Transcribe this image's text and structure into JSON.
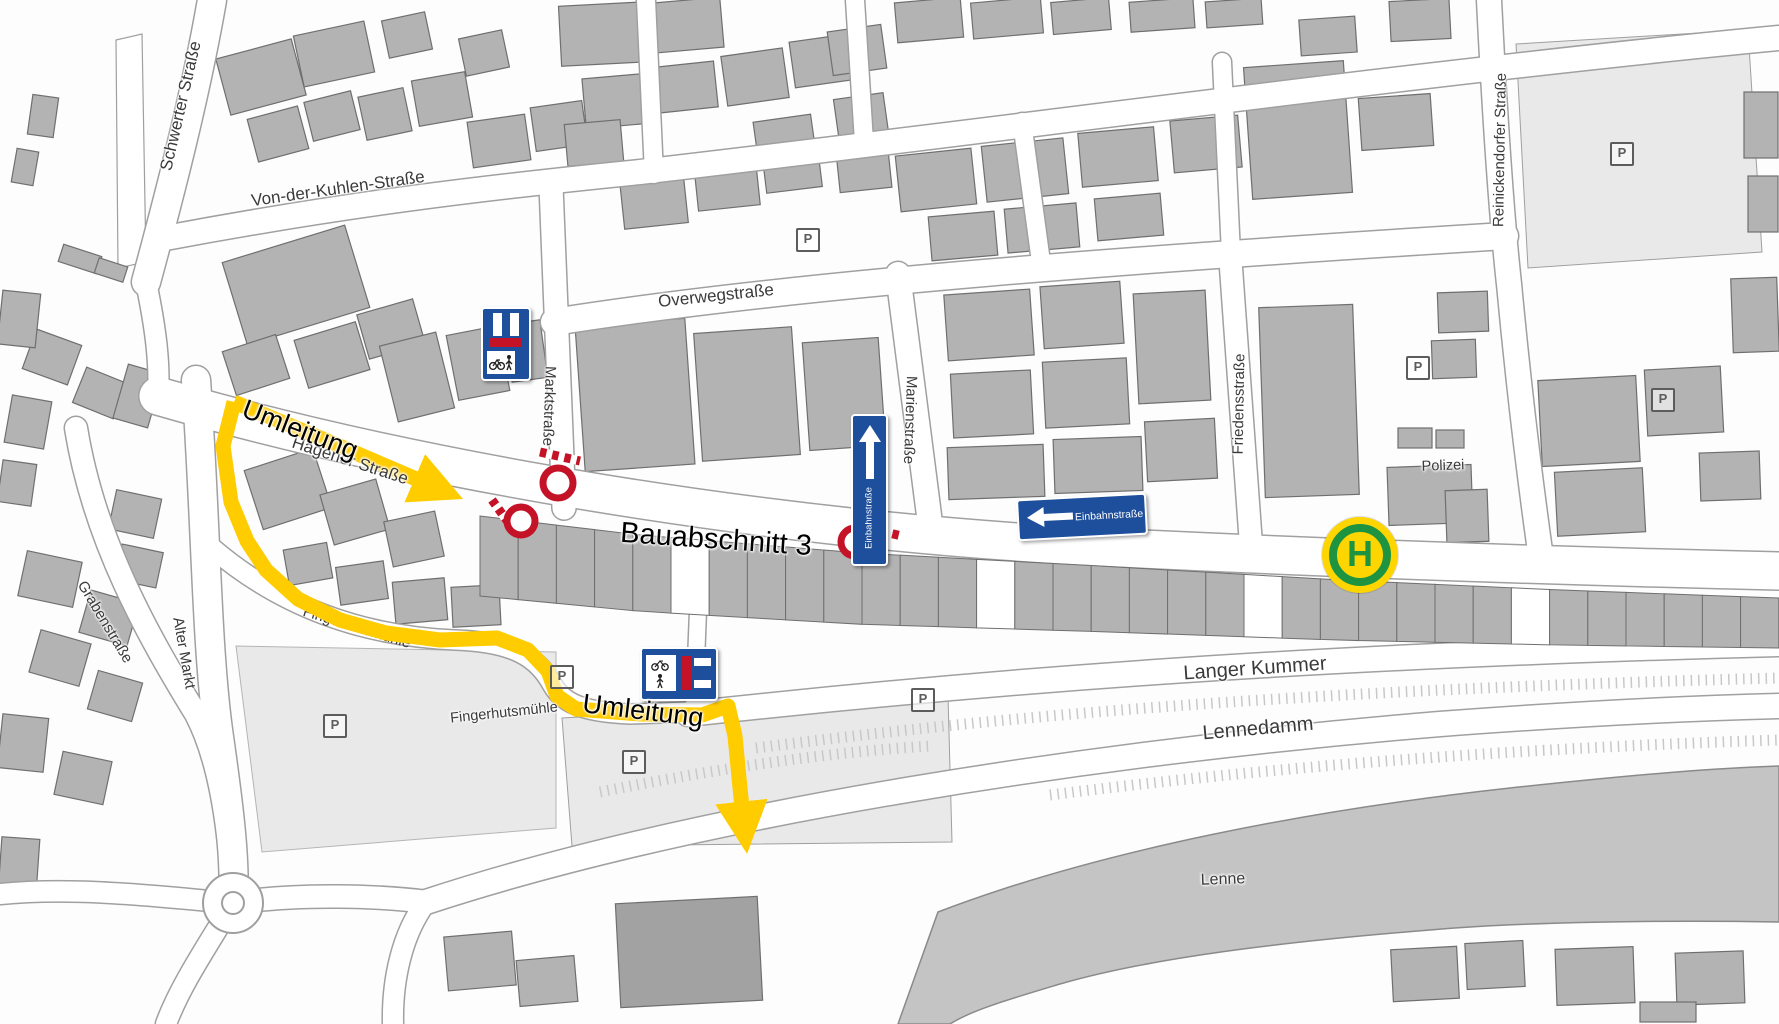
{
  "colors": {
    "yellow": "#FFCC00",
    "red": "#C41227",
    "blue": "#1E4F9C",
    "green": "#1E9440",
    "bus_yellow": "#FFD500",
    "building": "#B3B3B3",
    "building_dark": "#A2A2A2",
    "river": "#C4C4C4",
    "patch": "#E9E9E9",
    "casing": "#A0A0A0",
    "label": "#3A3A3A"
  },
  "labels": {
    "schwerter": "Schwerter Straße",
    "vdk": "Von-der-Kuhlen-Straße",
    "overweg": "Overwegstraße",
    "markt": "Marktstraße",
    "hagener": "Hagener Straße",
    "marien": "Marienstraße",
    "friedens": "Friedensstraße",
    "reinickendorfer": "Reinickendorfer Straße",
    "polizei": "Polizei",
    "graben": "Grabenstraße",
    "altermarkt": "Alter Markt",
    "fingerhut": "Fingerhutsmühle",
    "fingerhut2": "Fingerhutsmühle",
    "langerkummer": "Langer Kummer",
    "lennedamm": "Lennedamm",
    "lenne": "Lenne",
    "umleitung1": "Umleitung",
    "umleitung2": "Umleitung",
    "bauabschnitt": "Bauabschnitt 3",
    "parking": "P",
    "busstop": "H",
    "einbahn": "Einbahnstraße"
  },
  "route": {
    "width": 15,
    "paths": {
      "hagener_arrow": "234,402 330,442 428,484",
      "detour_arrow": "234,402 223,446 231,502 247,541 266,570 298,599 340,620 386,633 440,640 497,638 528,650 548,671 557,696 576,709 640,714 702,715 728,706 735,736 740,788 743,816"
    }
  },
  "geometry": {
    "river": "M938,912 C1100,850 1310,810 1510,788 C1650,773 1720,768 1779,766 L1779,922 C1660,920 1520,922 1430,930 C1280,942 1150,958 1060,984 C1010,999 972,1010 950,1024 L898,1024 Z",
    "patches": {
      "lot_ne": "M1516,44 L1748,30 L1762,252 L1528,268 Z",
      "plaza": "M236,646 L556,652 L556,828 L262,852 Z",
      "lot_s": "M562,718 L948,696 L952,842 L572,846 Z",
      "hatch_schwerter": "M118,268 L116,40 L142,34 L146,262 Z"
    },
    "streets": [
      {
        "d": "M158,396 C420,472 760,528 1080,546 C1320,558 1560,566 1779,571",
        "w": 37
      },
      {
        "d": "M551,186 L564,508",
        "w": 23
      },
      {
        "d": "M554,322 C800,283 1150,258 1505,236",
        "w": 26
      },
      {
        "d": "M160,239 C340,205 480,188 640,172 C980,133 1420,72 1779,38",
        "w": 24
      },
      {
        "d": "M146,282 C172,186 196,92 212,0",
        "w": 28
      },
      {
        "d": "M146,282 C156,330 160,364 158,396",
        "w": 20
      },
      {
        "d": "M898,274 L930,523",
        "w": 24
      },
      {
        "d": "M1230,254 L1251,545",
        "w": 22
      },
      {
        "d": "M1489,0 C1495,120 1502,220 1509,284 C1518,380 1530,480 1541,558",
        "w": 24
      },
      {
        "d": "M646,0 L654,174",
        "w": 18
      },
      {
        "d": "M855,0 L864,142",
        "w": 18
      },
      {
        "d": "M1022,122 L1041,262",
        "w": 18
      },
      {
        "d": "M1222,62 L1231,254",
        "w": 18
      },
      {
        "d": "M196,380 C206,520 206,640 218,730 C228,800 236,860 233,903",
        "w": 28
      },
      {
        "d": "M76,428 C94,540 148,636 196,714 C220,760 230,830 233,900",
        "w": 22
      },
      {
        "d": "M212,548 C280,606 360,636 455,640 C515,642 538,658 552,684 C562,702 580,712 630,714 L744,710",
        "w": 19
      },
      {
        "d": "M688,714 C1000,680 1310,656 1779,644",
        "w": 24
      },
      {
        "d": "M426,902 C700,812 1100,752 1440,724 C1600,712 1700,708 1779,706",
        "w": 24
      },
      {
        "d": "M700,560 L694,712",
        "w": 16
      },
      {
        "d": "M233,903 C300,893 380,896 428,902",
        "w": 22
      },
      {
        "d": "M233,903 C206,948 180,986 166,1024",
        "w": 20
      },
      {
        "d": "M233,903 C170,898 80,886 0,894",
        "w": 20
      },
      {
        "d": "M426,902 C402,934 392,980 393,1024",
        "w": 20
      }
    ],
    "terrace": {
      "x0": 480,
      "step": 38.2,
      "n": 34,
      "h0": 80,
      "hslope": -0.0231,
      "white": [
        5,
        13,
        20,
        27
      ],
      "top": [
        [
          480,
          516
        ],
        [
          640,
          535
        ],
        [
          860,
          553
        ],
        [
          1100,
          566
        ],
        [
          1340,
          580
        ],
        [
          1560,
          590
        ],
        [
          1779,
          598
        ]
      ]
    },
    "buildings": [
      [
        222,
        48,
        78,
        58,
        -15
      ],
      [
        298,
        28,
        72,
        52,
        -12
      ],
      [
        385,
        16,
        44,
        38,
        -12
      ],
      [
        252,
        112,
        52,
        44,
        -15
      ],
      [
        308,
        96,
        48,
        40,
        -14
      ],
      [
        362,
        92,
        46,
        44,
        -12
      ],
      [
        415,
        76,
        54,
        46,
        -10
      ],
      [
        462,
        34,
        44,
        38,
        -12
      ],
      [
        470,
        118,
        58,
        46,
        -8
      ],
      [
        533,
        104,
        52,
        44,
        -8
      ],
      [
        30,
        96,
        26,
        40,
        8
      ],
      [
        14,
        150,
        22,
        34,
        10
      ],
      [
        60,
        250,
        40,
        18,
        18
      ],
      [
        96,
        262,
        30,
        16,
        18
      ],
      [
        560,
        4,
        88,
        60,
        -3
      ],
      [
        656,
        0,
        66,
        50,
        -5
      ],
      [
        584,
        76,
        66,
        50,
        -5
      ],
      [
        658,
        64,
        58,
        46,
        -6
      ],
      [
        724,
        52,
        62,
        50,
        -8
      ],
      [
        792,
        38,
        58,
        46,
        -8
      ],
      [
        756,
        118,
        58,
        46,
        -8
      ],
      [
        566,
        122,
        56,
        42,
        -5
      ],
      [
        622,
        178,
        64,
        48,
        -6
      ],
      [
        696,
        162,
        62,
        46,
        -6
      ],
      [
        764,
        148,
        56,
        42,
        -7
      ],
      [
        830,
        28,
        54,
        44,
        -8
      ],
      [
        836,
        96,
        50,
        40,
        -8
      ],
      [
        838,
        150,
        52,
        40,
        -6
      ],
      [
        232,
        242,
        128,
        86,
        -17
      ],
      [
        300,
        330,
        64,
        50,
        -17
      ],
      [
        362,
        306,
        58,
        46,
        -16
      ],
      [
        228,
        342,
        56,
        46,
        -18
      ],
      [
        388,
        338,
        58,
        78,
        -14
      ],
      [
        452,
        330,
        52,
        66,
        -11
      ],
      [
        508,
        322,
        36,
        58,
        -8
      ],
      [
        580,
        322,
        110,
        146,
        -4
      ],
      [
        698,
        330,
        98,
        128,
        -4
      ],
      [
        806,
        340,
        76,
        108,
        -4
      ],
      [
        946,
        292,
        86,
        66,
        -4
      ],
      [
        1042,
        284,
        80,
        62,
        -4
      ],
      [
        952,
        372,
        80,
        64,
        -3
      ],
      [
        1044,
        360,
        84,
        66,
        -3
      ],
      [
        1136,
        292,
        72,
        110,
        -3
      ],
      [
        948,
        446,
        96,
        52,
        -2
      ],
      [
        1054,
        438,
        88,
        54,
        -2
      ],
      [
        1146,
        420,
        70,
        60,
        -3
      ],
      [
        898,
        152,
        76,
        56,
        -6
      ],
      [
        984,
        142,
        82,
        56,
        -6
      ],
      [
        1080,
        130,
        76,
        54,
        -5
      ],
      [
        1172,
        118,
        68,
        52,
        -5
      ],
      [
        1248,
        64,
        100,
        132,
        -4
      ],
      [
        1360,
        96,
        72,
        52,
        -4
      ],
      [
        930,
        214,
        66,
        44,
        -5
      ],
      [
        1006,
        206,
        72,
        44,
        -5
      ],
      [
        1096,
        196,
        66,
        42,
        -5
      ],
      [
        896,
        0,
        66,
        40,
        -5
      ],
      [
        972,
        0,
        70,
        36,
        -5
      ],
      [
        1052,
        0,
        58,
        32,
        -5
      ],
      [
        1130,
        0,
        64,
        30,
        -4
      ],
      [
        1206,
        0,
        56,
        26,
        -4
      ],
      [
        1390,
        0,
        60,
        40,
        -3
      ],
      [
        1300,
        18,
        56,
        36,
        -4
      ],
      [
        1262,
        306,
        94,
        190,
        -2
      ],
      [
        1398,
        428,
        34,
        20,
        0
      ],
      [
        1436,
        430,
        28,
        18,
        0
      ],
      [
        1388,
        466,
        84,
        58,
        -2
      ],
      [
        1438,
        292,
        50,
        40,
        -2
      ],
      [
        1432,
        340,
        44,
        38,
        -2
      ],
      [
        1446,
        490,
        42,
        52,
        -2
      ],
      [
        1540,
        378,
        98,
        86,
        -3
      ],
      [
        1646,
        368,
        76,
        66,
        -3
      ],
      [
        1556,
        470,
        88,
        64,
        -3
      ],
      [
        1744,
        92,
        34,
        66,
        0
      ],
      [
        1748,
        176,
        30,
        56,
        0
      ],
      [
        1732,
        278,
        46,
        74,
        -2
      ],
      [
        1700,
        452,
        60,
        48,
        -2
      ],
      [
        28,
        336,
        48,
        42,
        20
      ],
      [
        78,
        374,
        44,
        38,
        22
      ],
      [
        0,
        292,
        38,
        54,
        6
      ],
      [
        8,
        398,
        40,
        48,
        10
      ],
      [
        0,
        462,
        34,
        42,
        8
      ],
      [
        112,
        494,
        46,
        40,
        12
      ],
      [
        118,
        548,
        42,
        36,
        12
      ],
      [
        22,
        556,
        56,
        46,
        12
      ],
      [
        84,
        596,
        50,
        44,
        16
      ],
      [
        34,
        636,
        52,
        44,
        16
      ],
      [
        92,
        676,
        46,
        40,
        16
      ],
      [
        0,
        716,
        46,
        54,
        6
      ],
      [
        58,
        756,
        50,
        44,
        12
      ],
      [
        0,
        838,
        38,
        54,
        4
      ],
      [
        120,
        368,
        36,
        56,
        16
      ],
      [
        252,
        458,
        72,
        62,
        -18
      ],
      [
        326,
        486,
        58,
        52,
        -16
      ],
      [
        388,
        516,
        52,
        46,
        -12
      ],
      [
        286,
        546,
        44,
        36,
        -10
      ],
      [
        338,
        564,
        48,
        38,
        -8
      ],
      [
        394,
        580,
        52,
        42,
        -5
      ],
      [
        452,
        586,
        48,
        40,
        -3
      ],
      [
        618,
        900,
        142,
        104,
        -3,
        "#A2A2A2"
      ],
      [
        446,
        934,
        68,
        54,
        -5
      ],
      [
        518,
        958,
        58,
        46,
        -5
      ],
      [
        1392,
        948,
        66,
        52,
        -3
      ],
      [
        1466,
        942,
        58,
        46,
        -3
      ],
      [
        1556,
        948,
        78,
        56,
        -2
      ],
      [
        1676,
        952,
        68,
        52,
        -2
      ],
      [
        1640,
        1002,
        56,
        20,
        0
      ]
    ]
  }
}
